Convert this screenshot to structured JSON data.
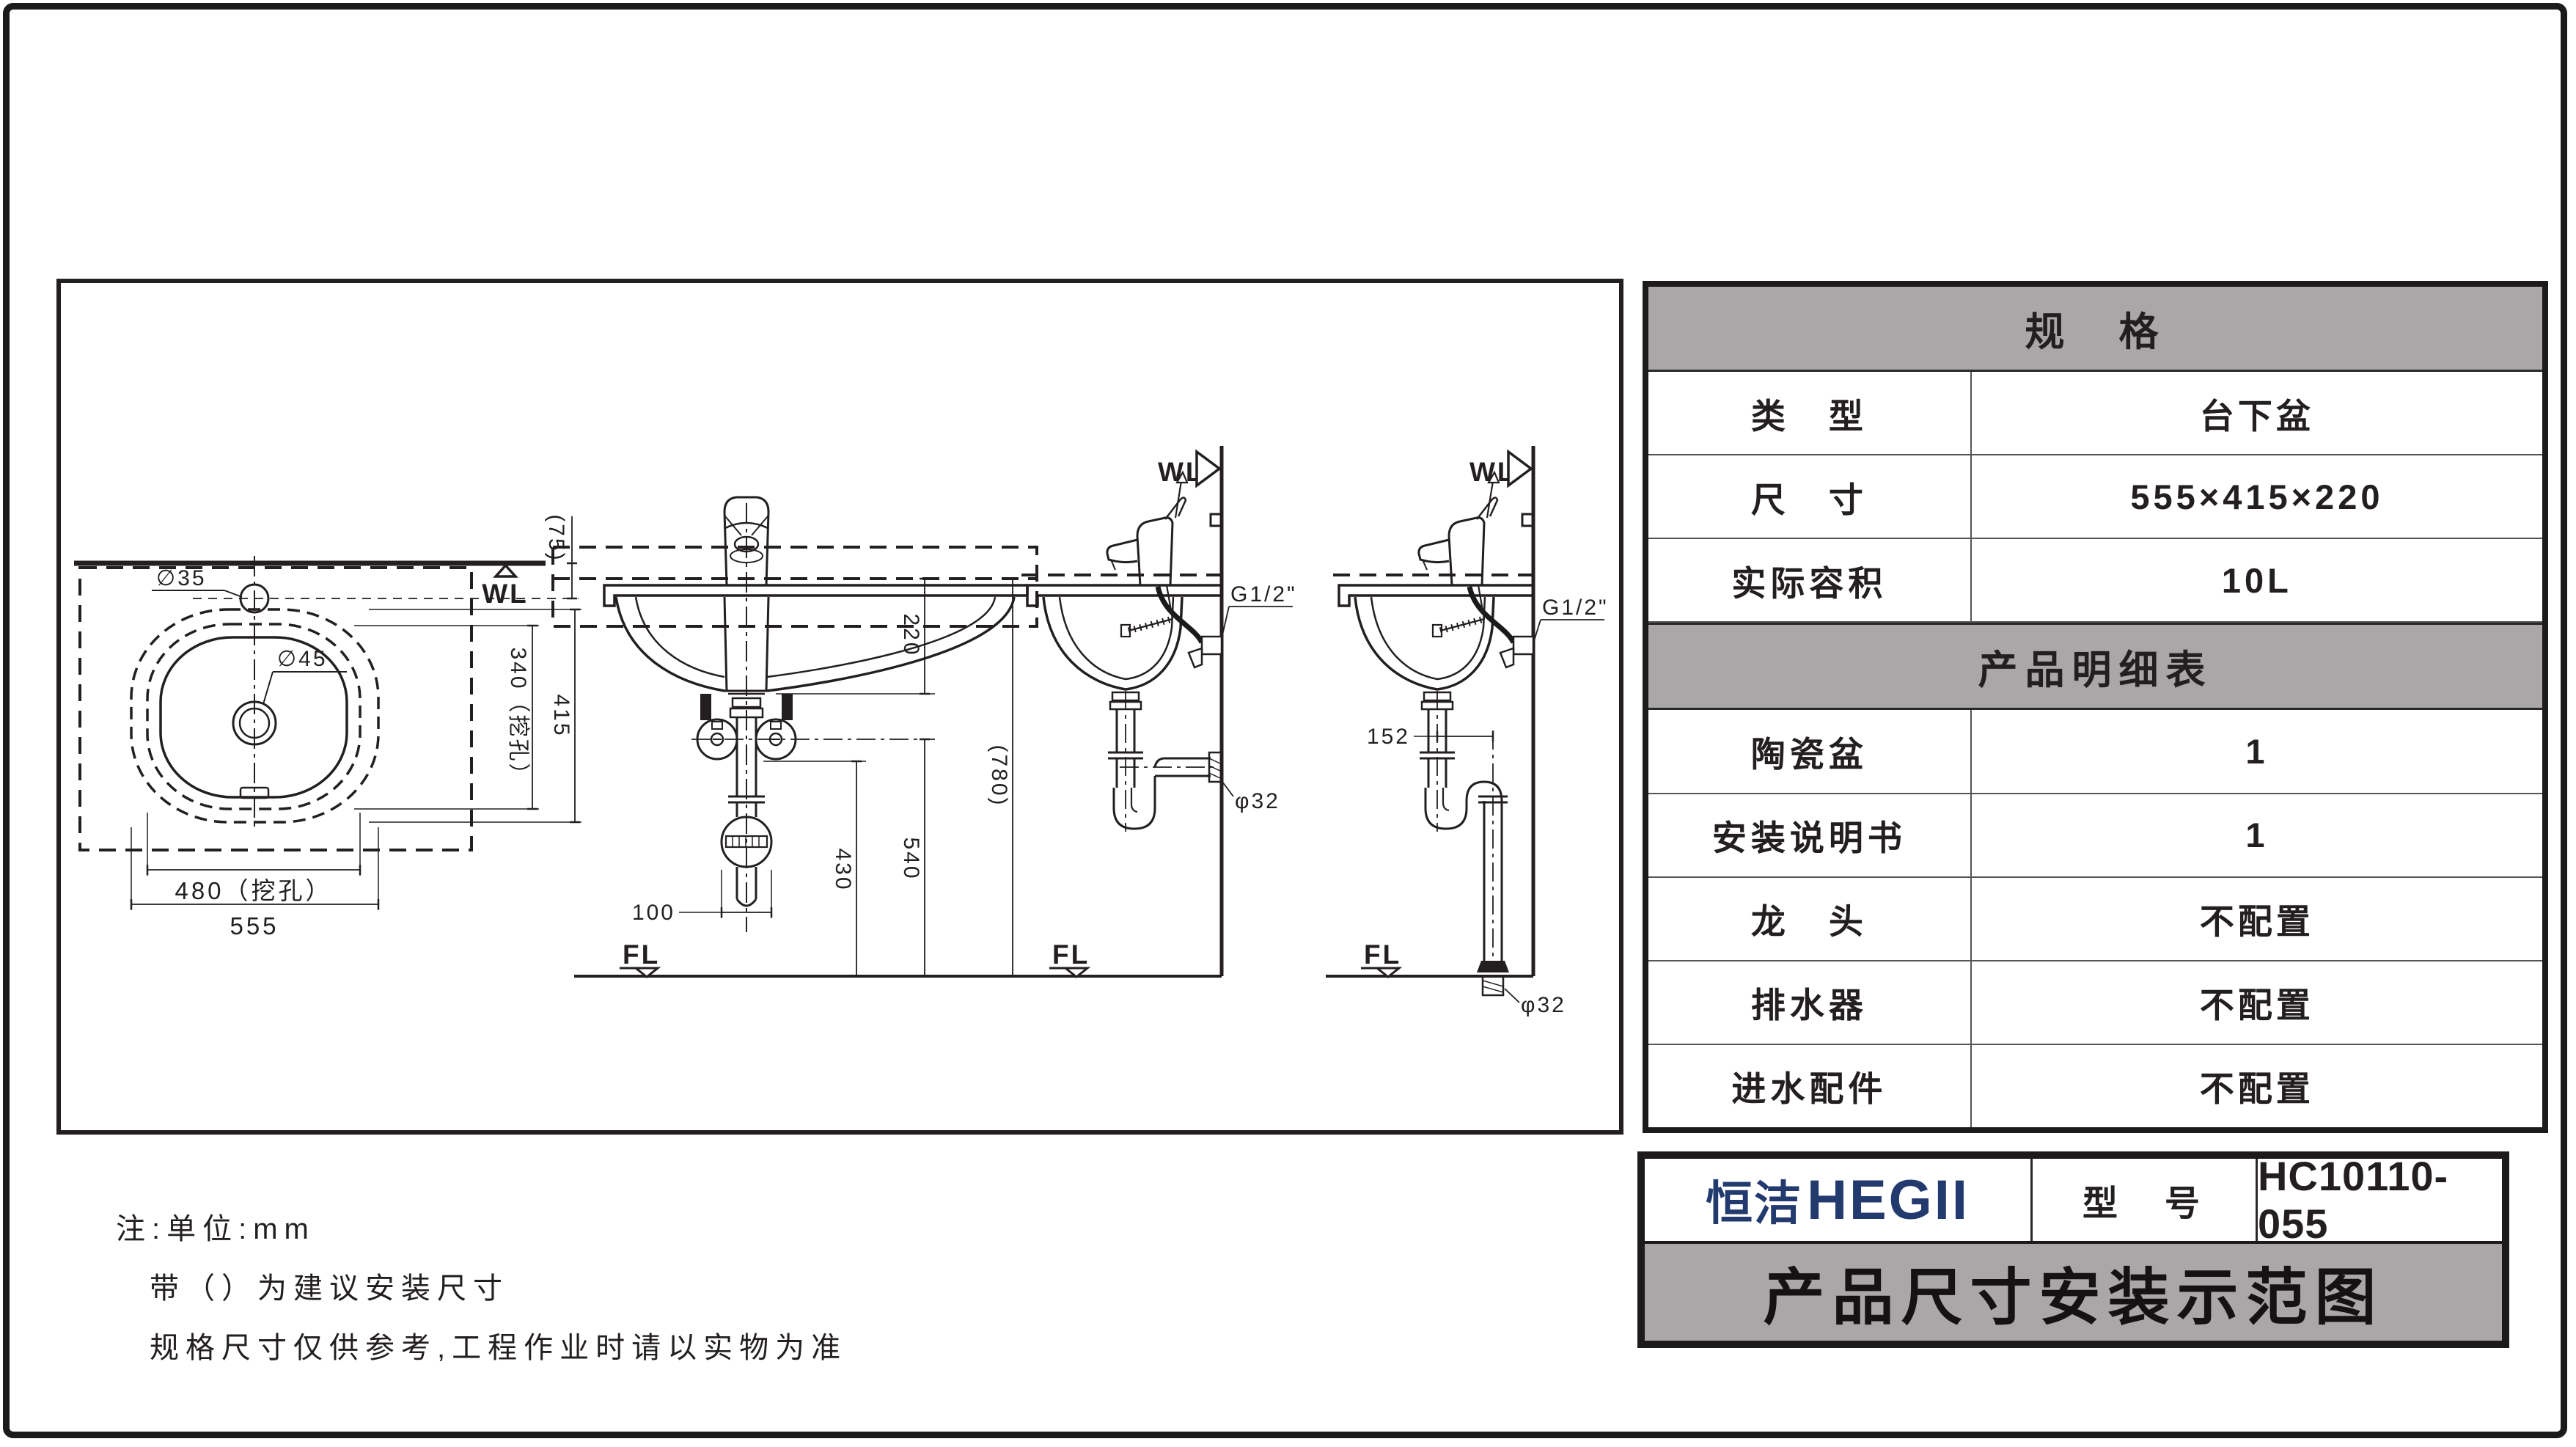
{
  "plan": {
    "wl": "WL",
    "dia_faucet_hole": "∅35",
    "dia_drain_hole": "∅45",
    "dim_wall_offset": "(75)",
    "dim_cutout_depth": "340（挖孔）",
    "dim_depth": "415",
    "dim_cutout_width": "480（挖孔）",
    "dim_width": "555"
  },
  "front": {
    "dim_height": "220",
    "dim_counter_height": "(780)",
    "dim_supply_height": "540",
    "dim_drain_height": "430",
    "dim_offset": "100",
    "fl": "FL"
  },
  "side_wall": {
    "wl": "WL",
    "supply_thread": "G1/2\"",
    "drain_dia": "φ32",
    "fl": "FL"
  },
  "side_floor": {
    "wl": "WL",
    "supply_thread": "G1/2\"",
    "dim_trap_offset": "152",
    "drain_dia": "φ32",
    "fl": "FL"
  },
  "spec_table": {
    "header": "规　格",
    "rows": [
      {
        "label": "类　型",
        "value": "台下盆"
      },
      {
        "label": "尺　寸",
        "value": "555×415×220"
      },
      {
        "label": "实际容积",
        "value": "10L"
      }
    ],
    "detail_header": "产品明细表",
    "detail_rows": [
      {
        "label": "陶瓷盆",
        "value": "1"
      },
      {
        "label": "安装说明书",
        "value": "1"
      },
      {
        "label": "龙　头",
        "value": "不配置"
      },
      {
        "label": "排水器",
        "value": "不配置"
      },
      {
        "label": "进水配件",
        "value": "不配置"
      }
    ]
  },
  "title_block": {
    "brand_cn": "恒洁",
    "brand_en": "HEGII",
    "model_label": "型　号",
    "model_value": "HC10110-055",
    "drawing_title": "产品尺寸安装示范图"
  },
  "notes": {
    "line1": "注:单位:mm",
    "line2": "带（）为建议安装尺寸",
    "line3": "规格尺寸仅供参考,工程作业时请以实物为准"
  },
  "colors": {
    "line": "#231f20",
    "gray": "#a9a7a8",
    "navy": "#233a6e"
  }
}
